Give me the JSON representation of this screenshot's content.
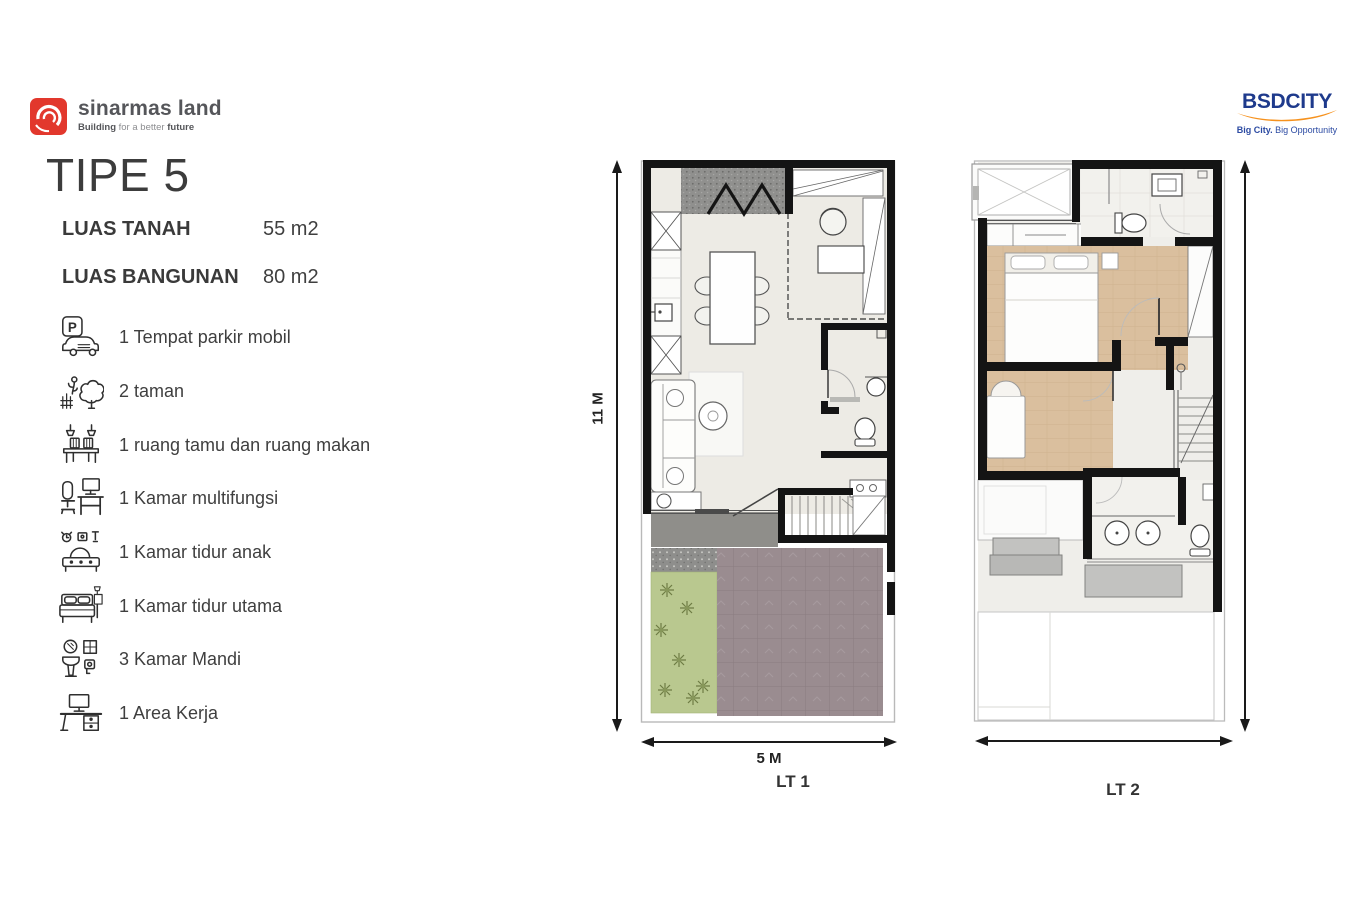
{
  "header": {
    "sinarmas": {
      "brand": "sinarmas land",
      "tagline_bold_1": "Building",
      "tagline_mid": " for a better ",
      "tagline_bold_2": "future"
    },
    "bsd": {
      "brand_bold": "BSD",
      "brand_rest": "CITY",
      "tagline_bold": "Big City.",
      "tagline_rest": " Big Opportunity"
    }
  },
  "unit": {
    "title": "TIPE 5",
    "specs": [
      {
        "label": "LUAS TANAH",
        "value": "55 m2"
      },
      {
        "label": "LUAS BANGUNAN",
        "value": "80 m2"
      }
    ],
    "features": [
      {
        "icon": "parking-icon",
        "label": "1 Tempat parkir mobil"
      },
      {
        "icon": "garden-icon",
        "label": "2 taman"
      },
      {
        "icon": "dining-icon",
        "label": "1 ruang tamu dan ruang makan"
      },
      {
        "icon": "multiroom-icon",
        "label": "1 Kamar multifungsi"
      },
      {
        "icon": "kid-bed-icon",
        "label": "1 Kamar tidur anak"
      },
      {
        "icon": "bed-icon",
        "label": "1 Kamar tidur utama"
      },
      {
        "icon": "bath-icon",
        "label": "3 Kamar Mandi"
      },
      {
        "icon": "work-desk-icon",
        "label": "1 Area Kerja"
      }
    ]
  },
  "icons": {
    "parking_letter": "P"
  },
  "plans": {
    "lt1": {
      "name": "LT 1",
      "width": "5 M",
      "height": "11 M"
    },
    "lt2": {
      "name": "LT 2"
    }
  },
  "colors": {
    "brand_red": "#e2382d",
    "brand_blue": "#1e3a8c",
    "accent_orange": "#f6921e",
    "wall": "#141414",
    "floor": "#edebe5",
    "wood": "#dabf9e",
    "garden": "#b9c88f",
    "carport": "#9a8c90",
    "terrace": "#8f8e8a",
    "canopy": "#c2c2c0"
  }
}
